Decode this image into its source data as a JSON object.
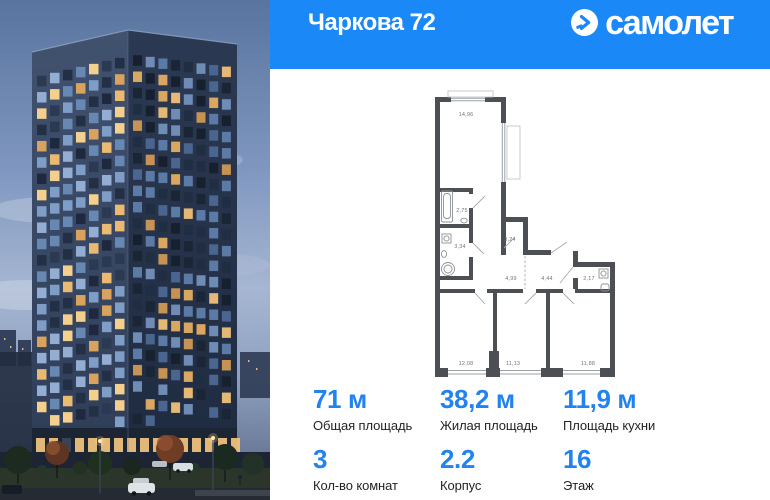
{
  "colors": {
    "brand_blue": "#1b88f7",
    "accent_blue": "#2383ee"
  },
  "header": {
    "title": "Чаркова 72",
    "brand_text": "самолет",
    "brand_icon": "samolet-arrow-circle"
  },
  "floorplan": {
    "room_areas": [
      {
        "label": "14,96",
        "x": 38,
        "y": 28
      },
      {
        "label": "2,75",
        "x": 34,
        "y": 124
      },
      {
        "label": "3,34",
        "x": 32,
        "y": 160
      },
      {
        "label": "3,24",
        "x": 82,
        "y": 153
      },
      {
        "label": "4,99",
        "x": 83,
        "y": 192
      },
      {
        "label": "4,44",
        "x": 119,
        "y": 192
      },
      {
        "label": "2,17",
        "x": 161,
        "y": 192
      },
      {
        "label": "12,08",
        "x": 38,
        "y": 277
      },
      {
        "label": "11,13",
        "x": 85,
        "y": 277
      },
      {
        "label": "11,88",
        "x": 160,
        "y": 277
      }
    ]
  },
  "stats": [
    {
      "value": "71 м",
      "label": "Общая площадь"
    },
    {
      "value": "38,2 м",
      "label": "Жилая площадь"
    },
    {
      "value": "11,9 м",
      "label": "Площадь кухни"
    },
    {
      "value": "3",
      "label": "Кол-во комнат"
    },
    {
      "value": "2.2",
      "label": "Корпус"
    },
    {
      "value": "16",
      "label": "Этаж"
    }
  ]
}
